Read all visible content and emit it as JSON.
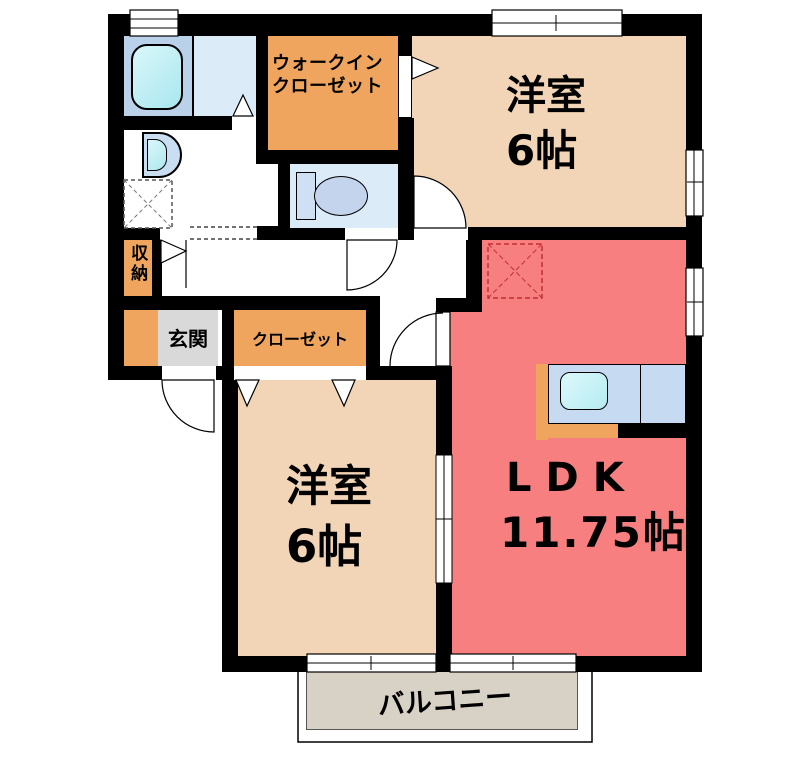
{
  "rooms": {
    "walk_in_closet": {
      "label_line1": "ウォークイン",
      "label_line2": "クローゼット"
    },
    "bedroom_top": {
      "label": "洋室",
      "size": "6帖"
    },
    "bedroom_bottom": {
      "label": "洋室",
      "size": "6帖"
    },
    "ldk": {
      "label": "LDK",
      "size": "11.75帖"
    },
    "entrance": {
      "label": "玄関"
    },
    "storage": {
      "label": "収納"
    },
    "closet": {
      "label": "クローゼット"
    },
    "balcony": {
      "label": "バルコニー"
    }
  },
  "colors": {
    "wall": "#000000",
    "bedroom_floor": "#f2d4b6",
    "ldk_floor": "#f87f7f",
    "closet_orange": "#efa55e",
    "bath_blue": "#b9d2ea",
    "sanitary_blue": "#dcebf8",
    "tub_cyan": "#b5ecf3",
    "entrance_gray": "#d9d9d9",
    "balcony_gray": "#d8d1c6",
    "kitchen_counter_blue": "#c6daf1",
    "refrigerator_dash_red": "#c03030"
  }
}
